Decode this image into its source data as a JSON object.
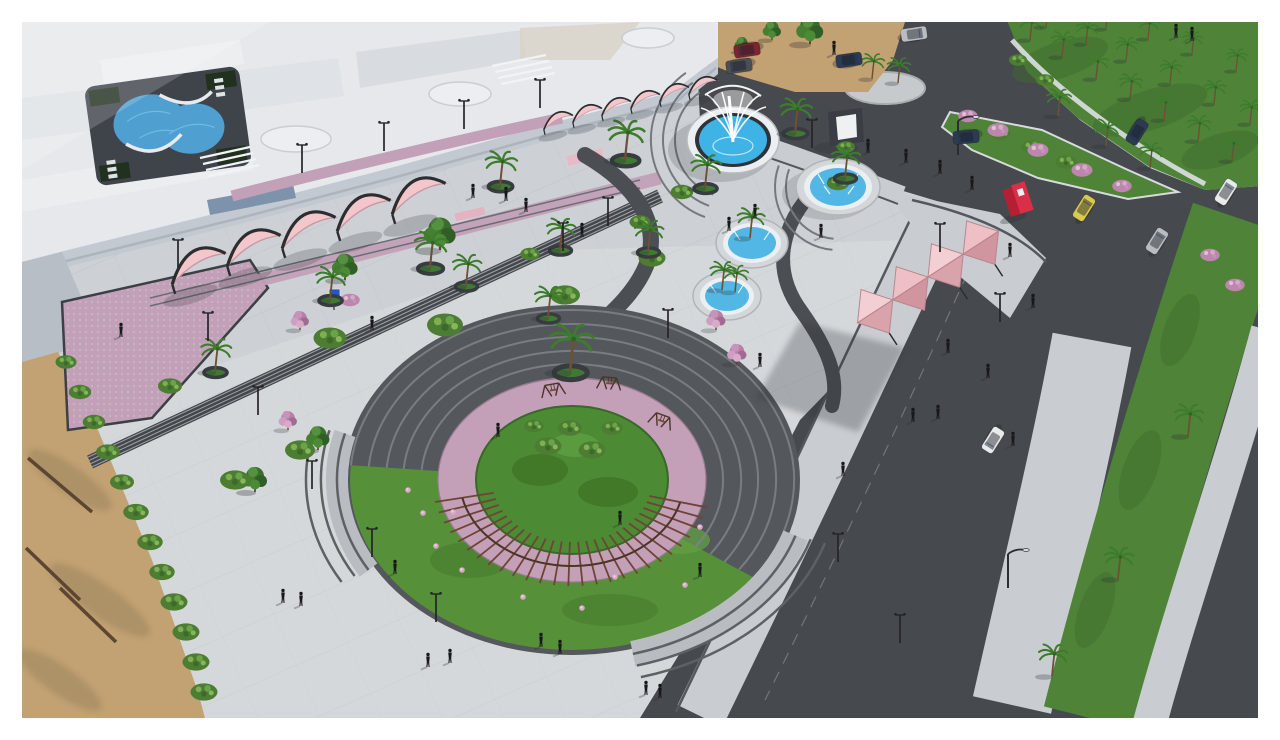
{
  "meta": {
    "title": "Aerial 3D render - public plaza landscape design",
    "caption": "3D architectural visualization, aerial view: landscaped public plaza with a circular amphitheater garden ringed by dark steps and a pink walkway, blue fountains with white jets, rows of pink shade canopies, palm trees in round planters, a white building complex with a courtyard pool, adjacent roads with cars, green medians with palms, and a sandy shore strip, framed by a white border."
  },
  "palette": {
    "frame": "#ffffff",
    "plaza": "#cdd1d5",
    "sidewalk": "#c9cdd1",
    "road": "#46494e",
    "curb": "#54575c",
    "grass": "#4e8338",
    "grassAmphi": "#569038",
    "garden": "#4d8a34",
    "sand": "#c2a172",
    "pinkPaving": "#c2a0b8",
    "pinkRing": "#c4a0b8",
    "canopyPink": "#f2c6cb",
    "canopyShade": "#d9a3ab",
    "buildingRoof": "#e6e8eb",
    "buildingFacade": "#c3c9d1",
    "poolDeck": "#3f444b",
    "poolWater": "#4f9fd0",
    "water": "#3fb2e6",
    "fountainRim": "#eceff2",
    "steps": "#43464b",
    "stepsLight": "#7e8287",
    "pergola": "#6e4436",
    "people": "#17181a",
    "red": "#d93049",
    "redDark": "#b51f33",
    "sign": "#2456c4",
    "cars": {
      "white": "#e9eaec",
      "silver": "#b9bdc2",
      "navy": "#2c3a54",
      "darkred": "#7c2430",
      "darkgrey": "#4a4e55",
      "yellow": "#d9c94e"
    }
  },
  "scene": {
    "pergola": {
      "cx": 572,
      "cy": 480,
      "rxIn": 80,
      "ryIn": 62,
      "rxOut": 140,
      "ryOut": 106,
      "railRx": 112,
      "railRy": 86,
      "a0": 15,
      "a1": 168,
      "n": 26
    },
    "layers": [
      {
        "name": "leafy-trees",
        "symbol": "sym-tree-leafy",
        "items": [
          [
            440,
            250,
            1.3
          ],
          [
            345,
            280,
            1.05
          ],
          [
            810,
            44,
            1.1
          ],
          [
            772,
            40,
            0.75
          ],
          [
            742,
            52,
            0.6
          ],
          [
            255,
            492,
            1.0
          ],
          [
            318,
            450,
            0.95
          ]
        ]
      },
      {
        "name": "pink-flowering-trees",
        "symbol": "sym-tree-pink",
        "items": [
          [
            716,
            330,
            0.9
          ],
          [
            737,
            364,
            0.9
          ],
          [
            300,
            330,
            0.85
          ],
          [
            288,
            430,
            0.85
          ]
        ]
      },
      {
        "name": "green-shrubs",
        "symbol": "sym-shrub-green",
        "items": [
          [
            66,
            362,
            1.4
          ],
          [
            80,
            392,
            1.5
          ],
          [
            94,
            422,
            1.5
          ],
          [
            108,
            452,
            1.6
          ],
          [
            122,
            482,
            1.6
          ],
          [
            136,
            512,
            1.7
          ],
          [
            150,
            542,
            1.7
          ],
          [
            162,
            572,
            1.7
          ],
          [
            174,
            602,
            1.8
          ],
          [
            186,
            632,
            1.8
          ],
          [
            196,
            662,
            1.8
          ],
          [
            204,
            692,
            1.8
          ],
          [
            330,
            338,
            2.2
          ],
          [
            445,
            325,
            2.4
          ],
          [
            565,
            295,
            2.0
          ],
          [
            652,
            258,
            1.8
          ],
          [
            682,
            192,
            1.5
          ],
          [
            640,
            222,
            1.4
          ],
          [
            170,
            386,
            1.6
          ],
          [
            235,
            480,
            2.0
          ],
          [
            300,
            450,
            2.0
          ],
          [
            530,
            254,
            1.3
          ],
          [
            1000,
            133,
            1.4
          ],
          [
            1032,
            147,
            1.4
          ],
          [
            1066,
            162,
            1.4
          ],
          [
            838,
            183,
            1.5
          ],
          [
            548,
            446,
            1.8
          ],
          [
            592,
            450,
            1.8
          ],
          [
            570,
            428,
            1.6
          ],
          [
            612,
            428,
            1.4
          ],
          [
            534,
            426,
            1.3
          ],
          [
            846,
            147,
            1.2
          ],
          [
            1018,
            60,
            1.2
          ],
          [
            1045,
            80,
            1.2
          ]
        ]
      },
      {
        "name": "pink-shrubs",
        "symbol": "sym-shrub-pink",
        "items": [
          [
            968,
            116,
            1.3
          ],
          [
            998,
            130,
            1.4
          ],
          [
            1038,
            150,
            1.4
          ],
          [
            1082,
            170,
            1.4
          ],
          [
            1122,
            186,
            1.3
          ],
          [
            350,
            300,
            1.3
          ],
          [
            1210,
            255,
            1.3
          ],
          [
            1235,
            285,
            1.3
          ]
        ]
      },
      {
        "name": "amphitheater-flowers",
        "symbol": "sym-flower",
        "items": [
          [
            423,
            513
          ],
          [
            453,
            512
          ],
          [
            462,
            570
          ],
          [
            523,
            597
          ],
          [
            582,
            608
          ],
          [
            615,
            577
          ],
          [
            685,
            585
          ],
          [
            700,
            527
          ],
          [
            408,
            490
          ],
          [
            436,
            546
          ]
        ]
      },
      {
        "name": "lawn-palms",
        "symbol": "sym-palm",
        "items": [
          [
            1030,
            40,
            0.8
          ],
          [
            1062,
            57,
            0.8
          ],
          [
            1096,
            79,
            0.8
          ],
          [
            1130,
            99,
            0.8
          ],
          [
            1164,
            120,
            0.8
          ],
          [
            1198,
            141,
            0.8
          ],
          [
            1232,
            161,
            0.8
          ],
          [
            1046,
            27,
            0.75
          ],
          [
            1086,
            44,
            0.75
          ],
          [
            1126,
            61,
            0.75
          ],
          [
            1170,
            84,
            0.75
          ],
          [
            1214,
            104,
            0.75
          ],
          [
            1250,
            124,
            0.75
          ],
          [
            1106,
            29,
            0.7
          ],
          [
            1148,
            39,
            0.7
          ],
          [
            1192,
            54,
            0.7
          ],
          [
            1236,
            71,
            0.7
          ],
          [
            1058,
            116,
            0.85
          ],
          [
            1106,
            146,
            0.85
          ],
          [
            1150,
            168,
            0.8
          ],
          [
            872,
            79,
            0.8
          ],
          [
            898,
            83,
            0.8
          ],
          [
            1188,
            436,
            1.0
          ],
          [
            1118,
            579,
            1.0
          ],
          [
            1052,
            676,
            1.0
          ],
          [
            750,
            238,
            0.95
          ],
          [
            722,
            290,
            0.9
          ],
          [
            735,
            292,
            0.85
          ]
        ]
      },
      {
        "name": "plaza-palms",
        "symbol": "sym-palm-planter",
        "items": [
          [
            500,
            186,
            1.1
          ],
          [
            625,
            160,
            1.25
          ],
          [
            705,
            188,
            1.05
          ],
          [
            795,
            133,
            1.1
          ],
          [
            845,
            178,
            1.0
          ],
          [
            548,
            318,
            1.0
          ],
          [
            330,
            300,
            1.05
          ],
          [
            430,
            268,
            1.15
          ],
          [
            466,
            286,
            1.0
          ],
          [
            560,
            250,
            1.0
          ],
          [
            215,
            372,
            1.05
          ],
          [
            648,
            252,
            1.0
          ],
          [
            570,
            372,
            1.5
          ]
        ]
      },
      {
        "name": "garden-swings",
        "symbol": "sym-swing",
        "items": [
          [
            548,
            392,
            1,
            -10
          ],
          [
            604,
            384,
            1,
            5
          ],
          [
            656,
            420,
            1,
            20
          ]
        ]
      },
      {
        "name": "canopy-row-left",
        "symbol": "sym-sail",
        "items": [
          [
            198,
            266,
            2.0,
            -17
          ],
          [
            253,
            248,
            2.0,
            -17
          ],
          [
            308,
            230,
            2.0,
            -17
          ],
          [
            363,
            213,
            2.0,
            -17
          ],
          [
            418,
            196,
            2.0,
            -17
          ]
        ]
      },
      {
        "name": "canopy-row-top",
        "symbol": "sym-sail",
        "items": [
          [
            558,
            121,
            1.05,
            -13
          ],
          [
            587,
            114,
            1.05,
            -13
          ],
          [
            616,
            107,
            1.05,
            -13
          ],
          [
            645,
            100,
            1.05,
            -13
          ],
          [
            674,
            93,
            1.05,
            -13
          ],
          [
            703,
            86,
            1.05,
            -13
          ]
        ]
      },
      {
        "name": "street-lamps",
        "symbol": "sym-lamp",
        "items": [
          [
            178,
            268
          ],
          [
            208,
            341
          ],
          [
            258,
            415
          ],
          [
            312,
            489
          ],
          [
            372,
            557
          ],
          [
            436,
            622
          ],
          [
            302,
            173
          ],
          [
            384,
            151
          ],
          [
            464,
            129
          ],
          [
            540,
            108
          ],
          [
            608,
            226
          ],
          [
            563,
            251
          ],
          [
            668,
            338
          ],
          [
            838,
            562
          ],
          [
            900,
            643
          ],
          [
            940,
            252
          ],
          [
            1000,
            322
          ],
          [
            812,
            148
          ]
        ]
      },
      {
        "name": "road-lamps",
        "symbol": "sym-roadlamp",
        "items": [
          [
            1008,
            588
          ],
          [
            958,
            155
          ]
        ]
      },
      {
        "name": "people",
        "symbol": "sym-person",
        "items": [
          [
            473,
            193
          ],
          [
            506,
            196
          ],
          [
            526,
            207
          ],
          [
            582,
            232
          ],
          [
            755,
            213
          ],
          [
            729,
            226
          ],
          [
            821,
            233
          ],
          [
            868,
            148
          ],
          [
            906,
            158
          ],
          [
            940,
            169
          ],
          [
            1010,
            252
          ],
          [
            1033,
            303
          ],
          [
            948,
            348
          ],
          [
            988,
            373
          ],
          [
            913,
            417
          ],
          [
            938,
            414
          ],
          [
            1013,
            441
          ],
          [
            843,
            471
          ],
          [
            700,
            572
          ],
          [
            541,
            642
          ],
          [
            560,
            649
          ],
          [
            450,
            658
          ],
          [
            428,
            662
          ],
          [
            301,
            601
          ],
          [
            283,
            598
          ],
          [
            121,
            332
          ],
          [
            395,
            569
          ],
          [
            646,
            690
          ],
          [
            660,
            693
          ],
          [
            834,
            50
          ],
          [
            1192,
            36
          ],
          [
            1176,
            33
          ],
          [
            372,
            325
          ],
          [
            760,
            362
          ],
          [
            620,
            520
          ],
          [
            498,
            432
          ],
          [
            972,
            185
          ]
        ]
      },
      {
        "name": "cars",
        "symbol": "sym-car",
        "items": [
          [
            747,
            50,
            1,
            172,
            "darkred"
          ],
          [
            739,
            66,
            1,
            172,
            "darkgrey"
          ],
          [
            849,
            60,
            1,
            -8,
            "navy"
          ],
          [
            914,
            34,
            1,
            -8,
            "silver"
          ],
          [
            966,
            137,
            1,
            175,
            "navy"
          ],
          [
            1137,
            132,
            1,
            122,
            "navy"
          ],
          [
            1226,
            192,
            1,
            -58,
            "white"
          ],
          [
            1157,
            241,
            1,
            -58,
            "silver"
          ],
          [
            1084,
            208,
            1,
            -58,
            "yellow"
          ],
          [
            993,
            440,
            1,
            122,
            "white"
          ]
        ]
      }
    ]
  }
}
